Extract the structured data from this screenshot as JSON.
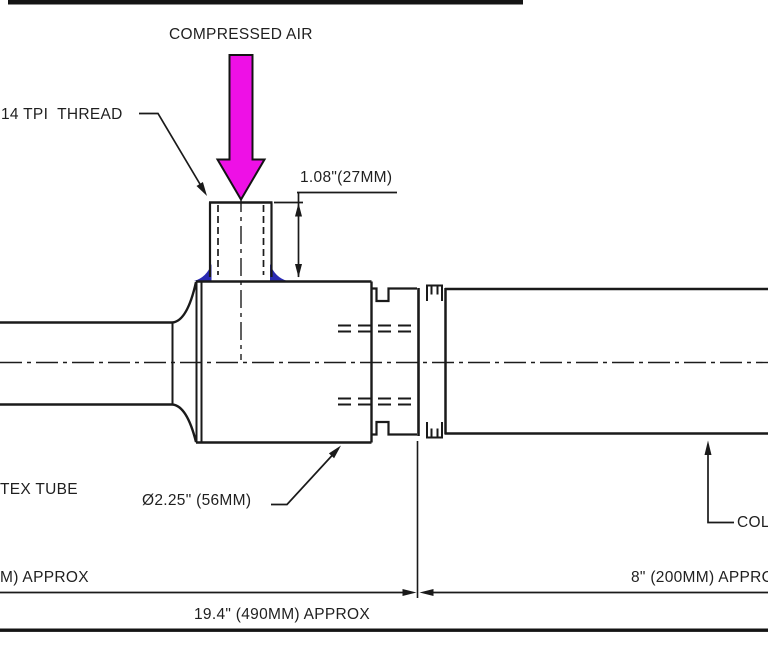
{
  "drawing": {
    "labels": {
      "compressed_air": "COMPRESSED AIR",
      "thread": "14 TPI  THREAD",
      "inlet_height_dim": "1.08\"(27MM)",
      "vortex_tube": "TEX TUBE",
      "body_diameter_dim": "Ø2.25\" (56MM)",
      "cold_end": "COLD",
      "left_length_dim": "M) APPROX",
      "right_length_dim": "8\" (200MM) APPROX",
      "total_length_dim": "19.4\" (490MM) APPROX"
    },
    "colors": {
      "line": "#1a1a1a",
      "compressed_air_arrow": "#ee10e6",
      "weld_fillet": "#2a2ab2",
      "background": "#ffffff"
    }
  }
}
